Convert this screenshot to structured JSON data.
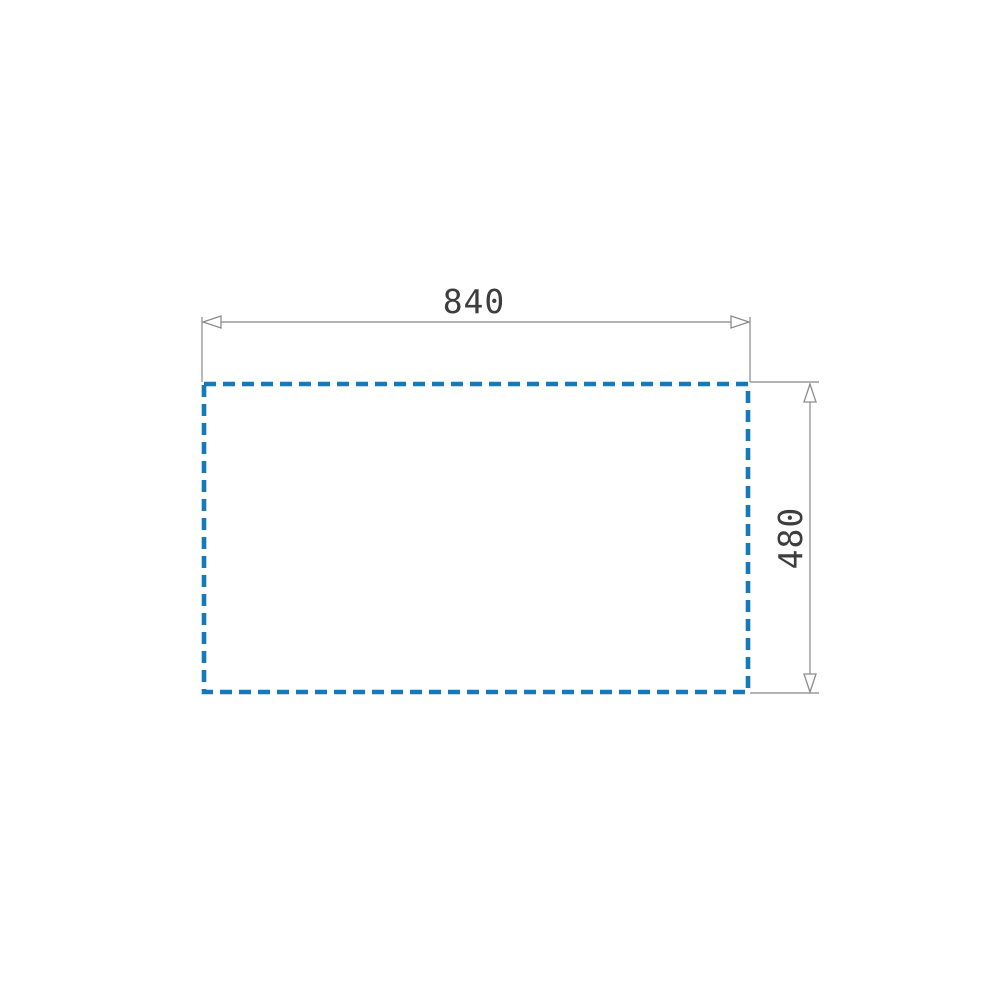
{
  "drawing": {
    "kind": "rectangle-dimension-diagram",
    "colors": {
      "outline_blue": "#1579ba",
      "dimension_gray": "#9a9a9a",
      "label_text": "#3d3d3d",
      "background": "#ffffff"
    },
    "rectangle": {
      "line_style": "dashed"
    },
    "dimensions": {
      "width": {
        "label": "840",
        "orientation": "horizontal",
        "position": "top"
      },
      "height": {
        "label": "480",
        "orientation": "vertical",
        "position": "right"
      }
    }
  }
}
